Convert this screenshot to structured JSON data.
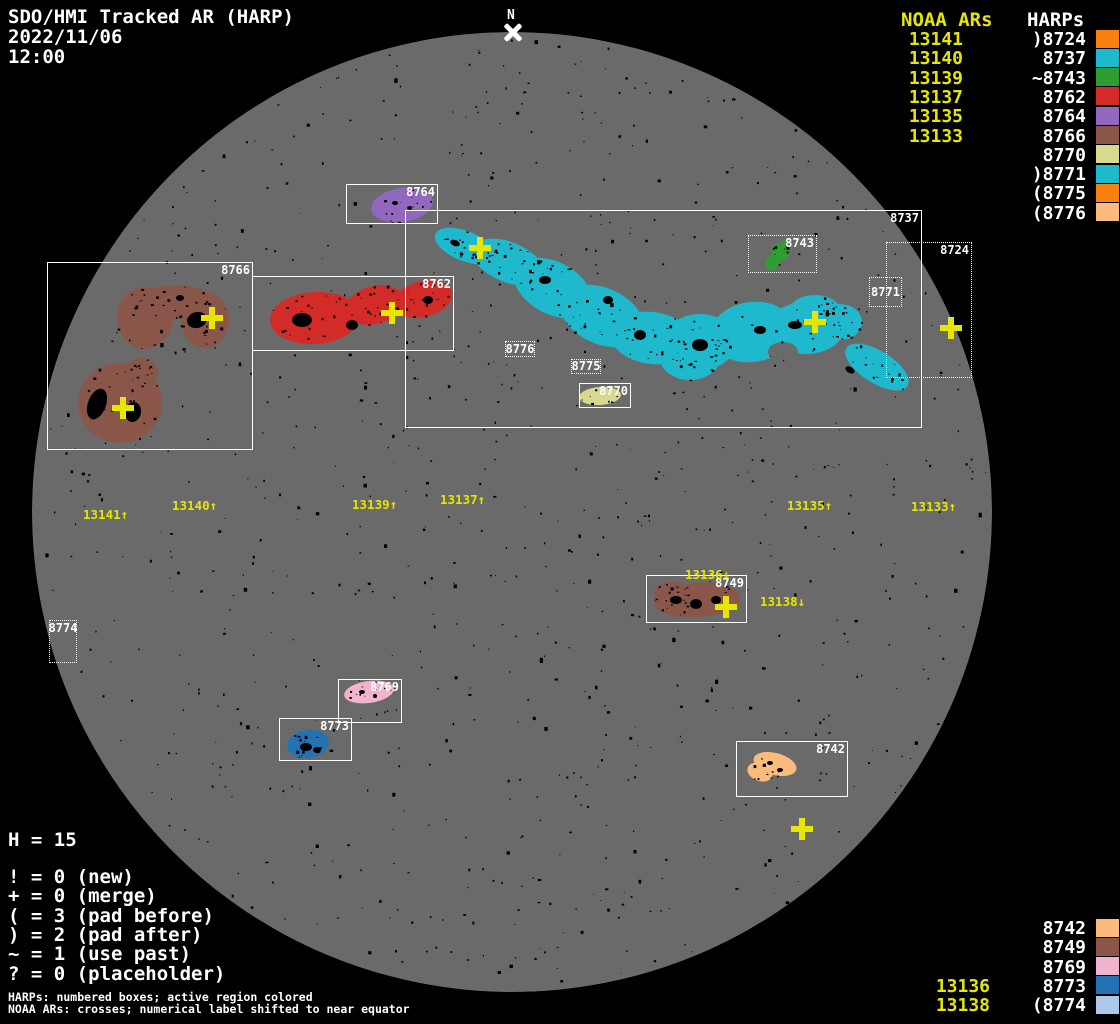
{
  "colors": {
    "background": "#000000",
    "disk_gray": "#6A6A6A",
    "annotation_yellow": "#E6E600",
    "annotation_white": "#FFFFFF"
  },
  "header": {
    "title": "SDO/HMI Tracked AR (HARP)",
    "date": "2022/11/06",
    "time": "12:00"
  },
  "north_marker": {
    "label": "N"
  },
  "top_right": {
    "noaa_header": "NOAA ARs",
    "harp_header": "HARPs",
    "rows": [
      {
        "noaa": "13141",
        "harp": ")8724",
        "color": "#F97F0F"
      },
      {
        "noaa": "13140",
        "harp": "8737",
        "color": "#1FB9CE"
      },
      {
        "noaa": "13139",
        "harp": "~8743",
        "color": "#2F9E32"
      },
      {
        "noaa": "13137",
        "harp": "8762",
        "color": "#D32B27"
      },
      {
        "noaa": "13135",
        "harp": "8764",
        "color": "#9268BF"
      },
      {
        "noaa": "13133",
        "harp": "8766",
        "color": "#8B564A"
      },
      {
        "noaa": "",
        "harp": "8770",
        "color": "#D6D98E"
      },
      {
        "noaa": "",
        "harp": ")8771",
        "color": "#1FB9CE"
      },
      {
        "noaa": "",
        "harp": "(8775",
        "color": "#F97F0F"
      },
      {
        "noaa": "",
        "harp": "(8776",
        "color": "#FBBB7D"
      }
    ]
  },
  "bottom_right": {
    "rows": [
      {
        "noaa": "",
        "harp": "8742",
        "color": "#FBBB7D"
      },
      {
        "noaa": "",
        "harp": "8749",
        "color": "#8B564A"
      },
      {
        "noaa": "",
        "harp": "8769",
        "color": "#F2B3CE"
      },
      {
        "noaa": "13136",
        "harp": "8773",
        "color": "#2273B4"
      },
      {
        "noaa": "13138",
        "harp": "(8774",
        "color": "#AFC7E8"
      }
    ]
  },
  "stats": {
    "harp_count_line": "H = 15",
    "legend_lines": [
      "! = 0 (new)",
      "+ = 0 (merge)",
      "( = 3 (pad before)",
      ") = 2 (pad after)",
      "~ = 1 (use past)",
      "? = 0 (placeholder)"
    ]
  },
  "footnotes": [
    "HARPs: numbered boxes; active region colored",
    "NOAA ARs: crosses; numerical label shifted to near equator"
  ],
  "disk": {
    "center": [
      512,
      512
    ],
    "radius": 480,
    "boxes": [
      {
        "harp": "8764",
        "x": 346,
        "y": 184,
        "w": 92,
        "h": 40,
        "style": "solid",
        "label_mode": "tr"
      },
      {
        "harp": "8766",
        "x": 47,
        "y": 262,
        "w": 206,
        "h": 188,
        "style": "solid",
        "label_mode": "tr"
      },
      {
        "harp": "8762",
        "x": 252,
        "y": 276,
        "w": 202,
        "h": 75,
        "style": "solid",
        "label_mode": "tr"
      },
      {
        "harp": "8737",
        "x": 405,
        "y": 210,
        "w": 517,
        "h": 218,
        "style": "solid",
        "label_mode": "tr"
      },
      {
        "harp": "8770",
        "x": 579,
        "y": 383,
        "w": 52,
        "h": 25,
        "style": "solid",
        "label_mode": "tr"
      },
      {
        "harp": "8749",
        "x": 646,
        "y": 575,
        "w": 101,
        "h": 48,
        "style": "solid",
        "label_mode": "tr"
      },
      {
        "harp": "8769",
        "x": 338,
        "y": 679,
        "w": 64,
        "h": 44,
        "style": "solid",
        "label_mode": "tr"
      },
      {
        "harp": "8773",
        "x": 279,
        "y": 718,
        "w": 73,
        "h": 43,
        "style": "solid",
        "label_mode": "tr"
      },
      {
        "harp": "8742",
        "x": 736,
        "y": 741,
        "w": 112,
        "h": 56,
        "style": "solid",
        "label_mode": "tr"
      },
      {
        "harp": "8743",
        "x": 748,
        "y": 235,
        "w": 69,
        "h": 38,
        "style": "dotted",
        "label_mode": "tr"
      },
      {
        "harp": "8724",
        "x": 886,
        "y": 242,
        "w": 86,
        "h": 136,
        "style": "dotted",
        "label_mode": "tr"
      },
      {
        "harp": "8771",
        "x": 869,
        "y": 277,
        "w": 33,
        "h": 30,
        "style": "dotted",
        "label_mode": "fill"
      },
      {
        "harp": "8775",
        "x": 571,
        "y": 359,
        "w": 30,
        "h": 15,
        "style": "dotted",
        "label_mode": "fill"
      },
      {
        "harp": "8776",
        "x": 505,
        "y": 341,
        "w": 30,
        "h": 16,
        "style": "dotted",
        "label_mode": "fill"
      },
      {
        "harp": "8774",
        "x": 49,
        "y": 620,
        "w": 28,
        "h": 43,
        "style": "dotted",
        "label_mode": "topfill"
      }
    ],
    "crosses": [
      {
        "noaa": "13140",
        "x": 212,
        "y": 318
      },
      {
        "noaa": "13141",
        "x": 123,
        "y": 408
      },
      {
        "noaa": "13139",
        "x": 392,
        "y": 313
      },
      {
        "noaa": "13137",
        "x": 480,
        "y": 248
      },
      {
        "noaa": "13135",
        "x": 815,
        "y": 322
      },
      {
        "noaa": "13133",
        "x": 951,
        "y": 328
      },
      {
        "noaa": "13136",
        "x": 726,
        "y": 607
      },
      {
        "noaa": "13138",
        "x": 802,
        "y": 829
      }
    ],
    "noaa_labels": [
      {
        "text": "13141↑",
        "x": 83,
        "y": 507
      },
      {
        "text": "13140↑",
        "x": 172,
        "y": 498
      },
      {
        "text": "13139↑",
        "x": 352,
        "y": 497
      },
      {
        "text": "13137↑",
        "x": 440,
        "y": 492
      },
      {
        "text": "13135↑",
        "x": 787,
        "y": 498
      },
      {
        "text": "13133↑",
        "x": 911,
        "y": 499
      },
      {
        "text": "13136↓",
        "x": 685,
        "y": 567
      },
      {
        "text": "13138↓",
        "x": 760,
        "y": 594
      }
    ],
    "regions": [
      {
        "harp": "8766",
        "color": "#8B564A",
        "ellipses": [
          [
            145,
            318,
            28,
            31,
            0
          ],
          [
            205,
            320,
            24,
            28,
            0
          ],
          [
            175,
            301,
            37,
            16,
            0
          ],
          [
            120,
            403,
            42,
            40,
            0
          ],
          [
            142,
            372,
            16,
            14,
            0
          ]
        ],
        "holes": [
          [
            174,
            349,
            10,
            17
          ]
        ],
        "spots": [
          [
            197,
            320,
            10,
            8,
            -15
          ],
          [
            97,
            404,
            9,
            16,
            20
          ],
          [
            133,
            412,
            8,
            10,
            10
          ],
          [
            180,
            298,
            4,
            3,
            0
          ]
        ],
        "speckles": 60
      },
      {
        "harp": "8762",
        "color": "#D32B27",
        "ellipses": [
          [
            315,
            318,
            45,
            26,
            -4
          ],
          [
            375,
            305,
            30,
            19,
            -14
          ],
          [
            423,
            299,
            30,
            18,
            -14
          ]
        ],
        "holes": [],
        "spots": [
          [
            302,
            320,
            10,
            7,
            0
          ],
          [
            352,
            325,
            6,
            5,
            0
          ],
          [
            428,
            300,
            5,
            4,
            0
          ]
        ],
        "speckles": 45
      },
      {
        "harp": "8764",
        "color": "#9268BF",
        "ellipses": [
          [
            402,
            205,
            31,
            17,
            -9
          ]
        ],
        "holes": [],
        "spots": [
          [
            395,
            203,
            3,
            2,
            0
          ],
          [
            410,
            208,
            2,
            2,
            0
          ]
        ],
        "speckles": 14
      },
      {
        "harp": "8743",
        "color": "#2F9E32",
        "ellipses": [
          [
            780,
            252,
            9,
            9,
            0
          ],
          [
            772,
            263,
            7,
            7,
            0
          ],
          [
            786,
            245,
            5,
            5,
            0
          ]
        ],
        "holes": [],
        "spots": [],
        "speckles": 8
      },
      {
        "harp": "8737",
        "color": "#1FB9CE",
        "ellipses": [
          [
            465,
            246,
            32,
            15,
            22
          ],
          [
            508,
            262,
            38,
            20,
            22
          ],
          [
            553,
            288,
            42,
            26,
            28
          ],
          [
            602,
            316,
            44,
            28,
            24
          ],
          [
            652,
            338,
            42,
            26,
            8
          ],
          [
            700,
            342,
            36,
            28,
            0
          ],
          [
            690,
            358,
            30,
            22,
            0
          ],
          [
            752,
            332,
            42,
            30,
            -8
          ],
          [
            806,
            328,
            38,
            26,
            0
          ],
          [
            815,
            310,
            25,
            15,
            0
          ],
          [
            840,
            322,
            22,
            18,
            0
          ],
          [
            877,
            367,
            36,
            16,
            32
          ]
        ],
        "holes": [
          [
            783,
            352,
            15,
            10
          ]
        ],
        "spots": [
          [
            455,
            243,
            5,
            3,
            20
          ],
          [
            545,
            280,
            6,
            4,
            0
          ],
          [
            640,
            335,
            6,
            5,
            0
          ],
          [
            700,
            345,
            8,
            6,
            0
          ],
          [
            760,
            330,
            6,
            4,
            0
          ],
          [
            795,
            325,
            7,
            4,
            0
          ],
          [
            850,
            370,
            5,
            3,
            30
          ],
          [
            608,
            300,
            5,
            4,
            0
          ]
        ],
        "speckles": 170
      },
      {
        "harp": "8770",
        "color": "#D6D98E",
        "ellipses": [
          [
            600,
            396,
            21,
            9,
            -4
          ]
        ],
        "holes": [],
        "spots": [],
        "speckles": 8
      },
      {
        "harp": "8749",
        "color": "#8B564A",
        "ellipses": [
          [
            697,
            600,
            43,
            17,
            -4
          ],
          [
            672,
            594,
            18,
            12,
            0
          ]
        ],
        "holes": [],
        "spots": [
          [
            676,
            600,
            6,
            4,
            0
          ],
          [
            696,
            604,
            6,
            5,
            0
          ],
          [
            716,
            600,
            5,
            4,
            0
          ]
        ],
        "speckles": 30
      },
      {
        "harp": "8769",
        "color": "#F2B3CE",
        "ellipses": [
          [
            369,
            692,
            25,
            11,
            -8
          ]
        ],
        "holes": [],
        "spots": [
          [
            362,
            692,
            3,
            2,
            0
          ],
          [
            375,
            696,
            2,
            2,
            0
          ]
        ],
        "speckles": 10
      },
      {
        "harp": "8773",
        "color": "#2273B4",
        "ellipses": [
          [
            308,
            744,
            21,
            14,
            -8
          ]
        ],
        "holes": [],
        "spots": [
          [
            306,
            747,
            6,
            4,
            0
          ],
          [
            317,
            750,
            4,
            3,
            0
          ]
        ],
        "speckles": 14
      },
      {
        "harp": "8742",
        "color": "#FBBB7D",
        "ellipses": [
          [
            775,
            764,
            22,
            11,
            15
          ],
          [
            760,
            772,
            13,
            9,
            20
          ]
        ],
        "holes": [],
        "spots": [
          [
            770,
            763,
            3,
            2,
            0
          ],
          [
            780,
            770,
            3,
            2,
            0
          ]
        ],
        "speckles": 12
      }
    ]
  },
  "chart_data": {
    "type": "scatter",
    "title": "SDO/HMI Tracked AR (HARP)",
    "timestamp": "2022/11/06 12:00",
    "harp_count": 15,
    "flag_counts": {
      "new": 0,
      "merge": 0,
      "pad_before": 3,
      "pad_after": 2,
      "use_past": 1,
      "placeholder": 0
    },
    "harp_regions": [
      {
        "harp": "8724",
        "flag": ")",
        "color": "#F97F0F"
      },
      {
        "harp": "8737",
        "flag": "",
        "color": "#1FB9CE"
      },
      {
        "harp": "8743",
        "flag": "~",
        "color": "#2F9E32"
      },
      {
        "harp": "8762",
        "flag": "",
        "color": "#D32B27"
      },
      {
        "harp": "8764",
        "flag": "",
        "color": "#9268BF"
      },
      {
        "harp": "8766",
        "flag": "",
        "color": "#8B564A"
      },
      {
        "harp": "8770",
        "flag": "",
        "color": "#D6D98E"
      },
      {
        "harp": "8771",
        "flag": ")",
        "color": "#1FB9CE"
      },
      {
        "harp": "8775",
        "flag": "(",
        "color": "#F97F0F"
      },
      {
        "harp": "8776",
        "flag": "(",
        "color": "#FBBB7D"
      },
      {
        "harp": "8742",
        "flag": "",
        "color": "#FBBB7D"
      },
      {
        "harp": "8749",
        "flag": "",
        "color": "#8B564A"
      },
      {
        "harp": "8769",
        "flag": "",
        "color": "#F2B3CE"
      },
      {
        "harp": "8773",
        "flag": "",
        "color": "#2273B4"
      },
      {
        "harp": "8774",
        "flag": "(",
        "color": "#AFC7E8"
      }
    ],
    "noaa_crosses": [
      {
        "noaa": "13141",
        "x": 123,
        "y": 408
      },
      {
        "noaa": "13140",
        "x": 212,
        "y": 318
      },
      {
        "noaa": "13139",
        "x": 392,
        "y": 313
      },
      {
        "noaa": "13137",
        "x": 480,
        "y": 248
      },
      {
        "noaa": "13135",
        "x": 815,
        "y": 322
      },
      {
        "noaa": "13133",
        "x": 951,
        "y": 328
      },
      {
        "noaa": "13136",
        "x": 726,
        "y": 607
      },
      {
        "noaa": "13138",
        "x": 802,
        "y": 829
      }
    ]
  }
}
